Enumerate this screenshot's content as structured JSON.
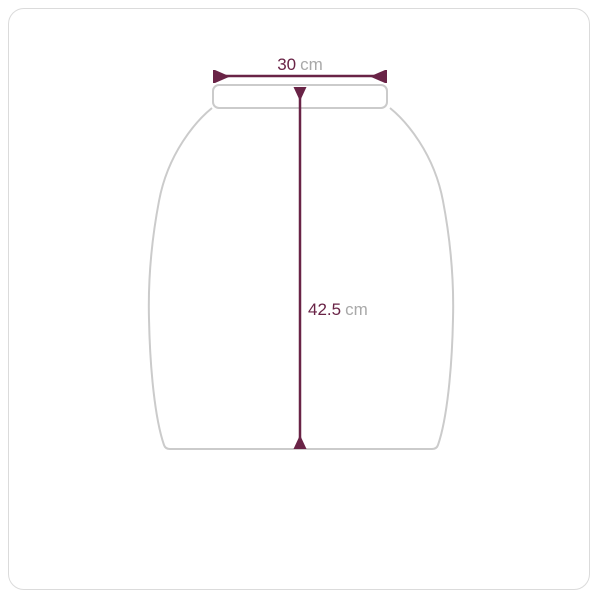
{
  "diagram": {
    "kind": "garment-size-measurement",
    "garment": "skirt-outline",
    "measurements": {
      "width": {
        "value": "30",
        "unit": "cm",
        "orientation": "horizontal"
      },
      "length": {
        "value": "42.5",
        "unit": "cm",
        "orientation": "vertical"
      }
    },
    "colors": {
      "dimension_line": "#692346",
      "value_text": "#692346",
      "unit_text": "#a9a9a9",
      "garment_outline": "#cbcbcb",
      "card_border": "#dbdbdb",
      "background": "#ffffff"
    }
  }
}
